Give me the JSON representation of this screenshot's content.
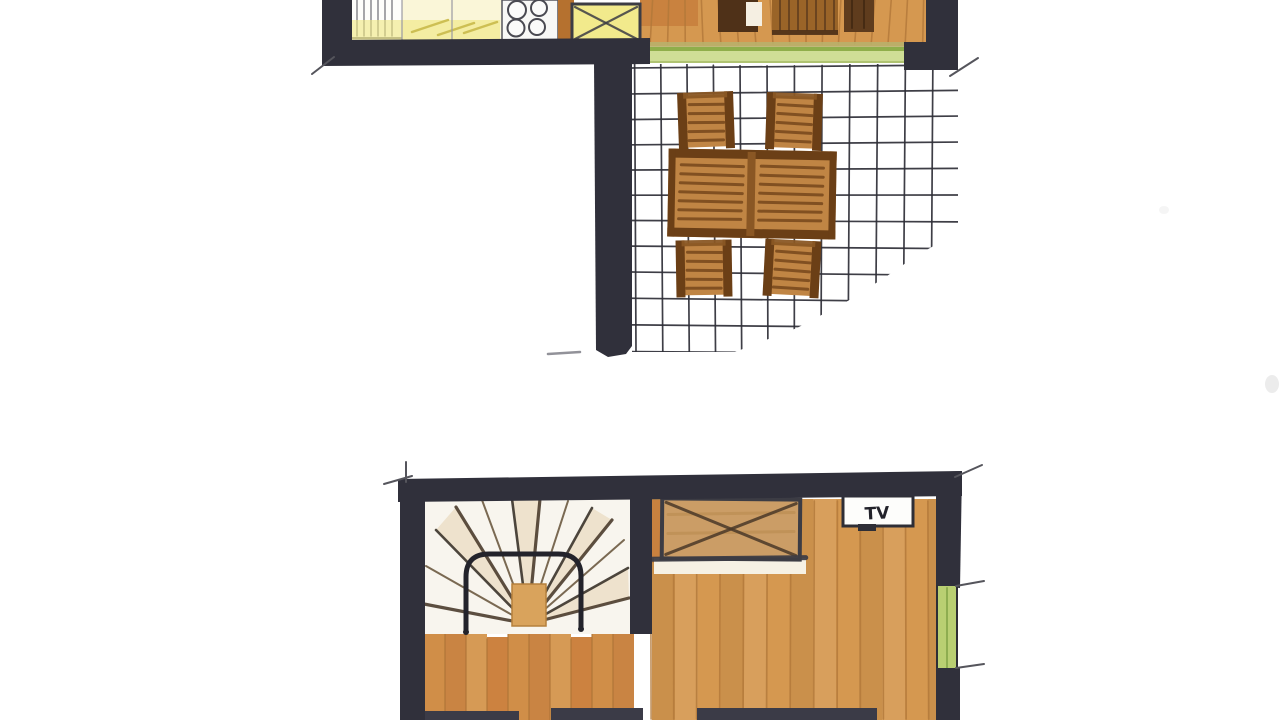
{
  "document": {
    "type": "floor-plan-sketch",
    "description": "Hand-drawn two-level apartment floor plan, marker and watercolor style, cropped at top and bottom",
    "levels": 2
  },
  "labels": {
    "tv": "TV"
  },
  "colors": {
    "paper": "#ffffff",
    "wall": "#30303b",
    "tick": "#55555c",
    "wood": "#d59850",
    "woodLine": "#b2783a",
    "woodDeep": "#c87f3d",
    "woodLeft": "#d08e48",
    "woodLineLeft": "#ad7336",
    "furniture": "#c08544",
    "furnitureFrame": "#6b3f16",
    "furnitureRail": "#8a5724",
    "furnitureSlat": "#7a4a1e",
    "darkWood": "#4f3118",
    "midWood": "#9a6428",
    "deepWood": "#5f3c1d",
    "cream": "#f5efe2",
    "tileLine": "#2e2e36",
    "doorGreen": "#cfde96",
    "doorGreenLine": "#8fae4a",
    "khaki": "#b9b06a",
    "windowGreen": "#b9cf72",
    "counter": "#faf6d8",
    "counterYellow": "#f0e87e",
    "counterStroke": "#c9b94a",
    "sinkYellow": "#f2ea8c",
    "inkDark": "#3c3c44",
    "pencil": "#6a6a72",
    "stairRay": "#4a3c2c",
    "rayLight": "#6b5a40",
    "rayDark": "#3a332a",
    "wedgeTan": "#e3cda4",
    "rail": "#23232b",
    "postWood": "#d9a35c",
    "postEdge": "#b5803c",
    "whiteWarm": "#f8f5ee",
    "halo": "#f6f1e4",
    "chestWood": "#cb9d66",
    "chestStreak": "#b98a4e",
    "chestCross": "#4a3828",
    "tvWhite": "#fdfdfb",
    "bedDark": "#3b3b47",
    "smudge": "#c9c9c9",
    "text": "#22222a"
  },
  "plan": {
    "upper_level": {
      "rooms": [
        "kitchen",
        "living area",
        "tiled terrace"
      ],
      "elements": [
        "kitchen counter",
        "4-burner cooktop",
        "sink unit with cross",
        "window",
        "green sliding patio door",
        "outdoor table",
        "4 outdoor chairs",
        "tiled terrace floor",
        "wood plank floor"
      ]
    },
    "lower_level": {
      "rooms": [
        "living / bedroom"
      ],
      "elements": [
        "winder staircase with fan treads",
        "curved stair handrail",
        "newel post",
        "crossed wardrobe chest",
        "TV cabinet",
        "green window in right wall",
        "wood plank floor",
        "cut-off furniture at bottom edge"
      ]
    }
  }
}
